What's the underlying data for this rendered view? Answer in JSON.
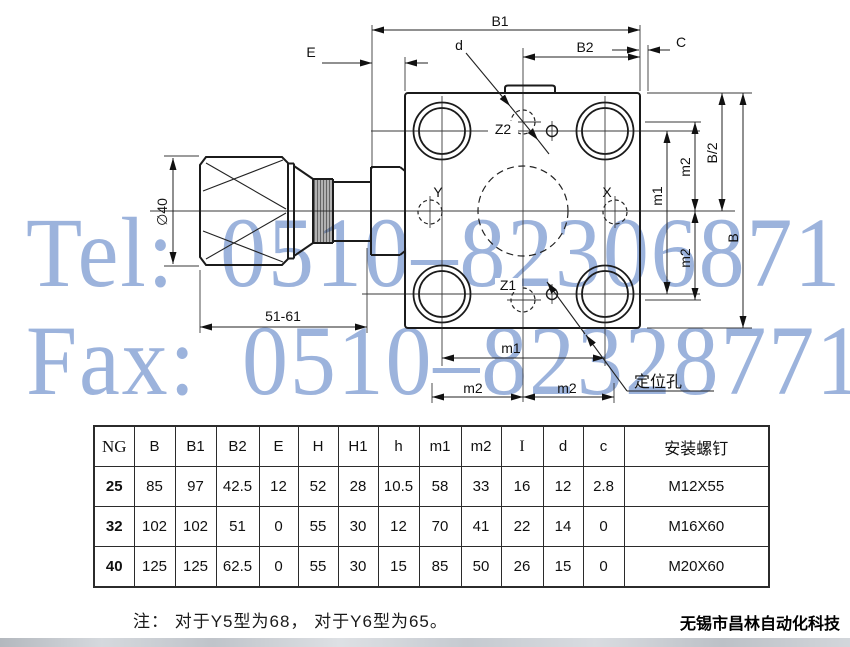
{
  "watermark": {
    "tel": "Tel: 0510–82306871",
    "fax": "Fax: 0510–82328771"
  },
  "colors": {
    "watermark": "#8ba6d7",
    "line": "#1b1b1b"
  },
  "drawing": {
    "labels": {
      "B1": "B1",
      "B2": "B2",
      "C": "C",
      "E": "E",
      "d": "d",
      "B": "B",
      "B_half": "B/2",
      "m1": "m1",
      "m2": "m2",
      "phi40": "∅40",
      "length_range": "51-61",
      "Z2": "Z2",
      "Z1": "Z1",
      "Y": "Y",
      "X": "X",
      "locating_hole": "定位孔"
    }
  },
  "table": {
    "headers": [
      "NG",
      "B",
      "B1",
      "B2",
      "E",
      "H",
      "H1",
      "h",
      "m1",
      "m2",
      "I",
      "d",
      "c",
      "安装螺钉"
    ],
    "rows": [
      [
        "25",
        "85",
        "97",
        "42.5",
        "12",
        "52",
        "28",
        "10.5",
        "58",
        "33",
        "16",
        "12",
        "2.8",
        "M12X55"
      ],
      [
        "32",
        "102",
        "102",
        "51",
        "0",
        "55",
        "30",
        "12",
        "70",
        "41",
        "22",
        "14",
        "0",
        "M16X60"
      ],
      [
        "40",
        "125",
        "125",
        "62.5",
        "0",
        "55",
        "30",
        "15",
        "85",
        "50",
        "26",
        "15",
        "0",
        "M20X60"
      ]
    ]
  },
  "note": "注： 对于Y5型为68， 对于Y6型为65。",
  "company": "无锡市昌林自动化科技"
}
